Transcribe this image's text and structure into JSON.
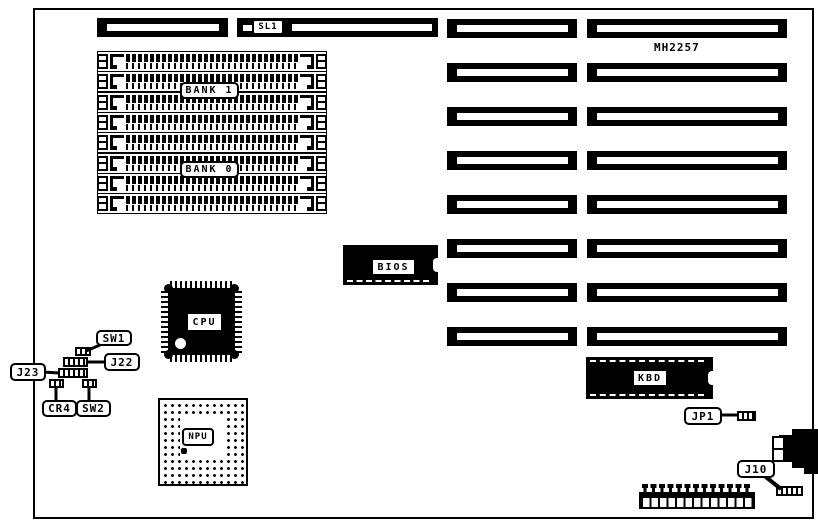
{
  "diagram": {
    "model": "MH2257",
    "labels": {
      "sl1": "SL1",
      "bank1": "BANK 1",
      "bank0": "BANK 0",
      "bios": "BIOS",
      "cpu": "CPU",
      "npu": "NPU",
      "kbd": "KBD",
      "sw1": "SW1",
      "j22": "J22",
      "j23": "J23",
      "cr4": "CR4",
      "sw2": "SW2",
      "jp1": "JP1",
      "j10": "J10"
    },
    "structure": {
      "expansion_slot_rows": 8,
      "simm_socket_rows": 8
    },
    "colors": {
      "ink": "#000000",
      "paper": "#ffffff"
    }
  }
}
